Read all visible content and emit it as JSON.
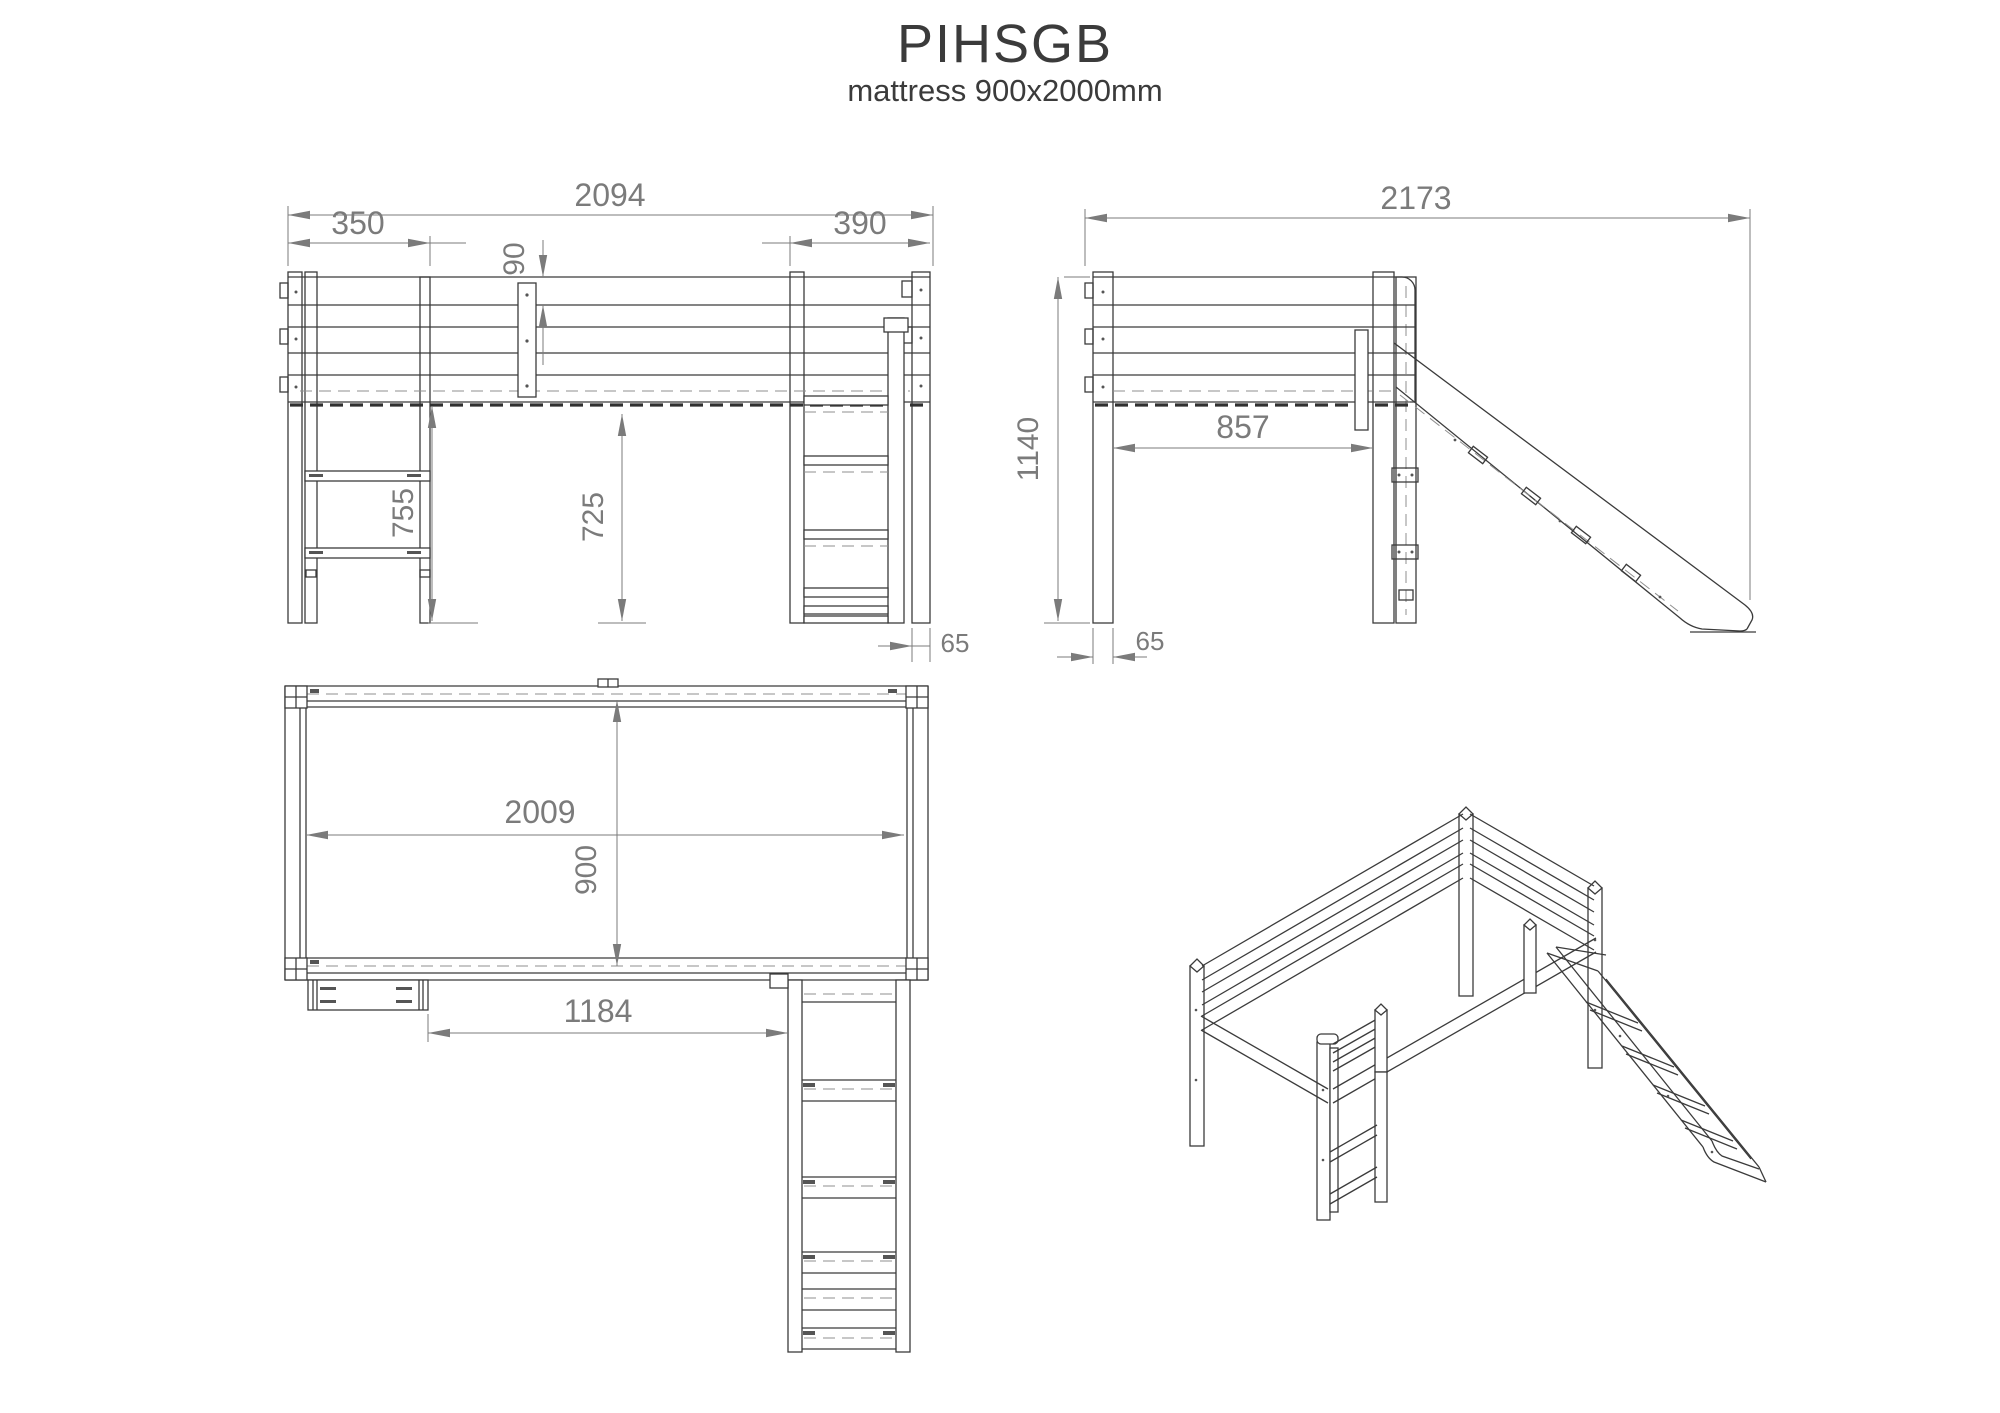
{
  "title": "PIHSGB",
  "subtitle": "mattress 900x2000mm",
  "front_view": {
    "label": "front elevation",
    "dim_overall_width": "2094",
    "dim_shelf_offset": "350",
    "dim_rail_height": "90",
    "dim_slide_bay_width": "390",
    "dim_under_clearance_left": "755",
    "dim_under_clearance_right": "725",
    "dim_post_width": "65"
  },
  "side_view": {
    "label": "side elevation with slide",
    "dim_overall_depth": "2173",
    "dim_height": "1140",
    "dim_inner_depth": "857",
    "dim_post_width": "65"
  },
  "top_view": {
    "label": "plan view",
    "dim_inner_length": "2009",
    "dim_inner_width": "900",
    "dim_shelf_to_ladder": "1184"
  },
  "isometric_view": {
    "label": "isometric projection of loft bed with slide"
  },
  "colors": {
    "line": "#3b3b3b",
    "hidden_line": "#8f8f8f",
    "dimension": "#7b7b7b",
    "background": "#ffffff"
  }
}
